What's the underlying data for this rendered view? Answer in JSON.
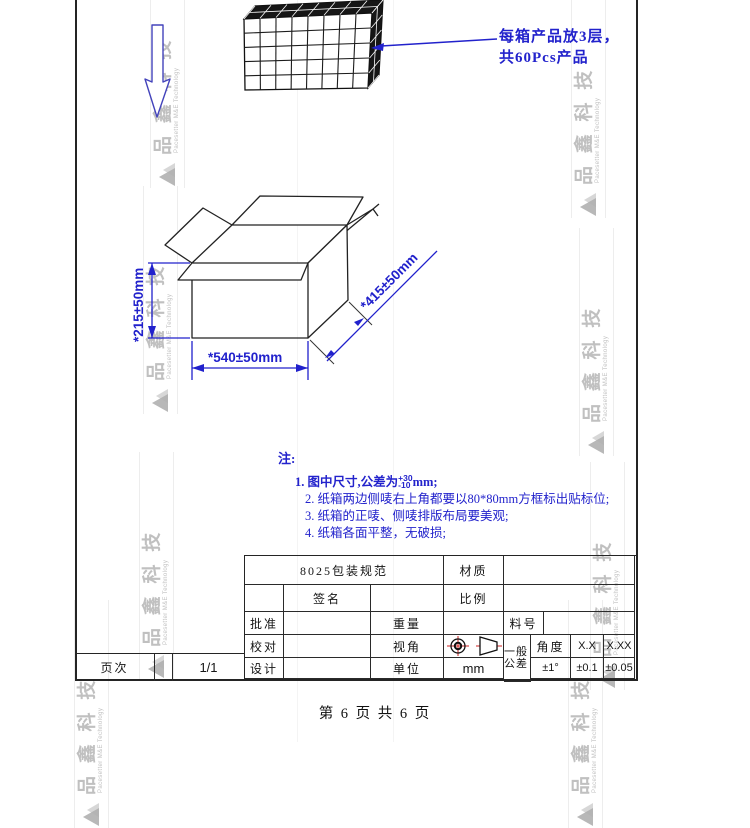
{
  "annotation": {
    "line1": "每箱产品放3层，",
    "line2": "共60Pcs产品"
  },
  "dimensions": {
    "height": "*215±50mm",
    "width": "*540±50mm",
    "depth": "*415±50mm"
  },
  "notes": {
    "header": "注:",
    "item1_prefix": "1. 图中尺寸,公差为",
    "item1_tol_plus": "+30",
    "item1_tol_minus": "-10",
    "item1_suffix": "mm;",
    "items": [
      "2. 纸箱两边侧唛右上角都要以80*80mm方框标出贴标位;",
      "3. 纸箱的正唛、侧唛排版布局要美观;",
      "4. 纸箱各面平整，无破损;"
    ]
  },
  "title_block": {
    "doc_title": "8025包装规范",
    "material_label": "材质",
    "signature_label": "签名",
    "scale_label": "比例",
    "approve_label": "批准",
    "weight_label": "重量",
    "part_no_label": "料号",
    "check_label": "校对",
    "view_angle_label": "视角",
    "general_tol_label": "一般公差",
    "angle_label": "角度",
    "tol_x_label": "X.X",
    "tol_xx_label": "X.XX",
    "design_label": "设计",
    "unit_label": "单位",
    "unit_value": "mm",
    "angle_tol_value": "±1°",
    "tol_x_value": "±0.1",
    "tol_xx_value": "±0.05",
    "page_label": "页次",
    "page_value": "1/1"
  },
  "footer": {
    "text": "第 6 页 共 6 页"
  },
  "watermark": {
    "text": "品 鑫 科 技",
    "subtext": "Pacesetter M&E Technology"
  },
  "colors": {
    "accent_blue": "#2222cc",
    "line_black": "#242424",
    "red": "#cc2222",
    "watermark_gray": "#8c8c8c"
  }
}
